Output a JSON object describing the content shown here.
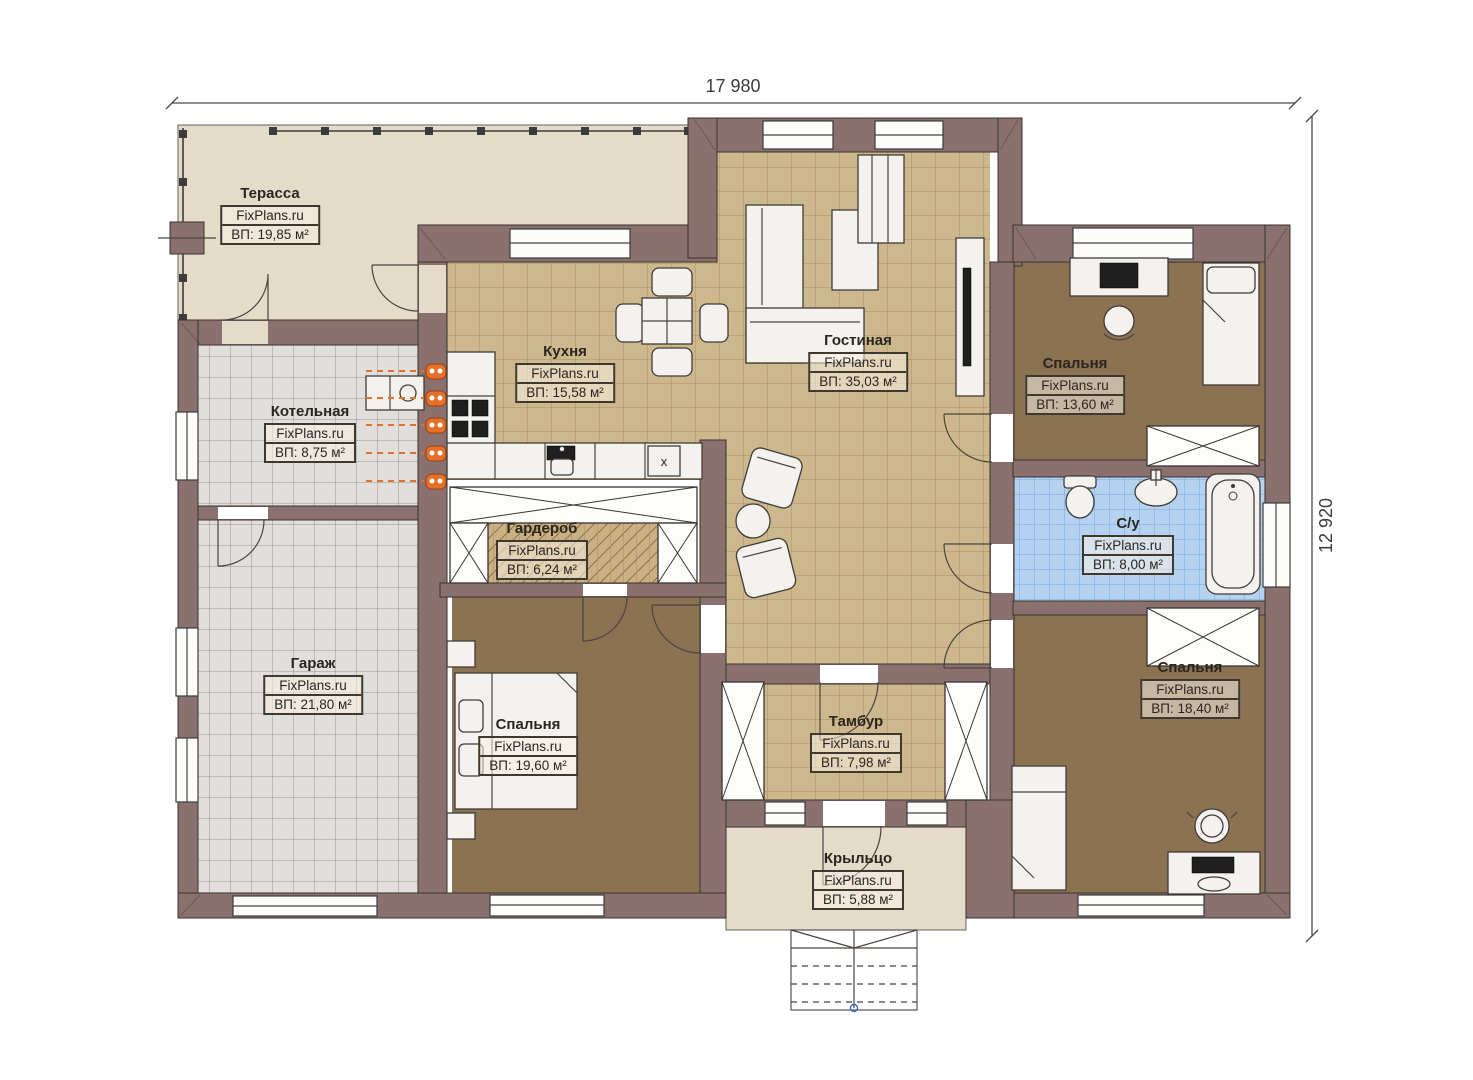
{
  "brand": "FixPlans.ru",
  "dimensions": {
    "width_label": "17 980",
    "height_label": "12 920"
  },
  "markers": {
    "dishwasher": "x"
  },
  "rooms": [
    {
      "id": "terrace",
      "name": "Терасса",
      "area": "ВП: 19,85 м²"
    },
    {
      "id": "kitchen",
      "name": "Кухня",
      "area": "ВП: 15,58 м²"
    },
    {
      "id": "living-room",
      "name": "Гостиная",
      "area": "ВП: 35,03 м²"
    },
    {
      "id": "bedroom-top-right",
      "name": "Спальня",
      "area": "ВП: 13,60 м²"
    },
    {
      "id": "boiler-room",
      "name": "Котельная",
      "area": "ВП: 8,75 м²"
    },
    {
      "id": "wardrobe",
      "name": "Гардероб",
      "area": "ВП: 6,24 м²"
    },
    {
      "id": "bathroom",
      "name": "С/у",
      "area": "ВП: 8,00 м²"
    },
    {
      "id": "garage",
      "name": "Гараж",
      "area": "ВП: 21,80 м²"
    },
    {
      "id": "bedroom-left",
      "name": "Спальня",
      "area": "ВП: 19,60 м²"
    },
    {
      "id": "vestibule",
      "name": "Тамбур",
      "area": "ВП: 7,98 м²"
    },
    {
      "id": "bedroom-bottom-right",
      "name": "Спальня",
      "area": "ВП: 18,40 м²"
    },
    {
      "id": "porch",
      "name": "Крыльцо",
      "area": "ВП: 5,88 м²"
    }
  ],
  "colors": {
    "wall": "#8a7170",
    "terrace_floor": "#e4dbc9",
    "tile_tan": "#cdb88d",
    "tile_gray": "#e0dfdc",
    "tile_blue": "#b5d3f1",
    "floor_brown": "#8b7253",
    "radiator": "#e4702a"
  }
}
